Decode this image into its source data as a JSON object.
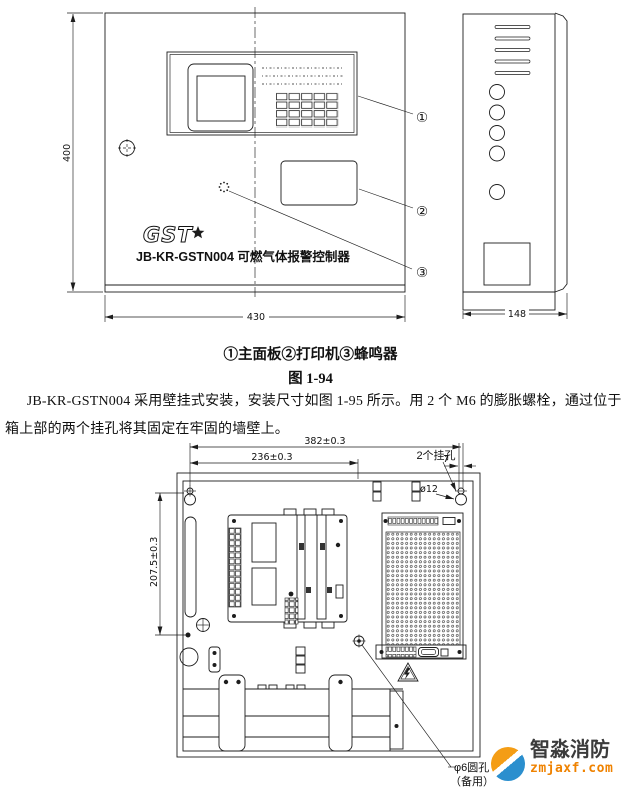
{
  "figure1": {
    "front_view": {
      "height_dim": "400",
      "width_dim": "430",
      "logo_text": "GST",
      "model_text": "JB-KR-GSTN004 可燃气体报警控制器"
    },
    "side_view": {
      "width_dim": "148"
    },
    "callouts": {
      "c1": "①",
      "c2": "②",
      "c3": "③"
    }
  },
  "caption": {
    "legend": "①主面板②打印机③蜂鸣器",
    "figure_no": "图 1-94"
  },
  "paragraph": {
    "line1": "JB-KR-GSTN004 采用壁挂式安装，安装尺寸如图 1-95 所示。用 2 个 M6 的膨胀螺栓，通过位于机",
    "line2": "箱上部的两个挂孔将其固定在牢固的墙壁上。"
  },
  "figure2": {
    "dims": {
      "d382": "382±0.3",
      "d236": "236±0.3",
      "d2075": "207.5±0.3",
      "d7": "7",
      "phi12": "ø12",
      "hang_holes": "2个挂孔",
      "spare_hole_1": "φ6圆孔",
      "spare_hole_2": "（备用）"
    }
  },
  "watermark": {
    "brand": "智淼消防",
    "url": "zmjaxf.com",
    "orange": "#ef8200",
    "blue": "#2b8fce"
  }
}
